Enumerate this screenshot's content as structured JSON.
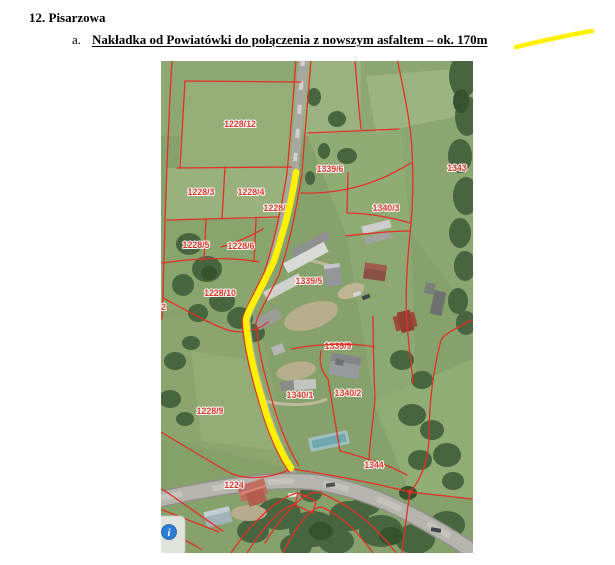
{
  "page": {
    "heading": "12. Pisarzowa",
    "list_marker": "a.",
    "item_text": "Nakładka od Powiatówki do połączenia z nowszym asfaltem – ok. 170m"
  },
  "map": {
    "parcel_labels": [
      {
        "text": "1228/12"
      },
      {
        "text": "1339/6"
      },
      {
        "text": "1343"
      },
      {
        "text": "1228/3"
      },
      {
        "text": "1228/4"
      },
      {
        "text": "1228/8"
      },
      {
        "text": "1340/3"
      },
      {
        "text": "1228/5"
      },
      {
        "text": "1228/6"
      },
      {
        "text": "1228/10"
      },
      {
        "text": "1339/5"
      },
      {
        "text": "2"
      },
      {
        "text": "1339/9"
      },
      {
        "text": "1340/1"
      },
      {
        "text": "1340/2"
      },
      {
        "text": "1228/9"
      },
      {
        "text": "1344"
      },
      {
        "text": "1224"
      }
    ],
    "info_icon_glyph": "i",
    "colors": {
      "highlight": "#fff200",
      "parcel_line": "#e23128",
      "parcel_label": "#dd3228",
      "field_green": "#87a16c",
      "road_gray": "#b5b5ad",
      "info_blue": "#2e7cd6"
    }
  }
}
